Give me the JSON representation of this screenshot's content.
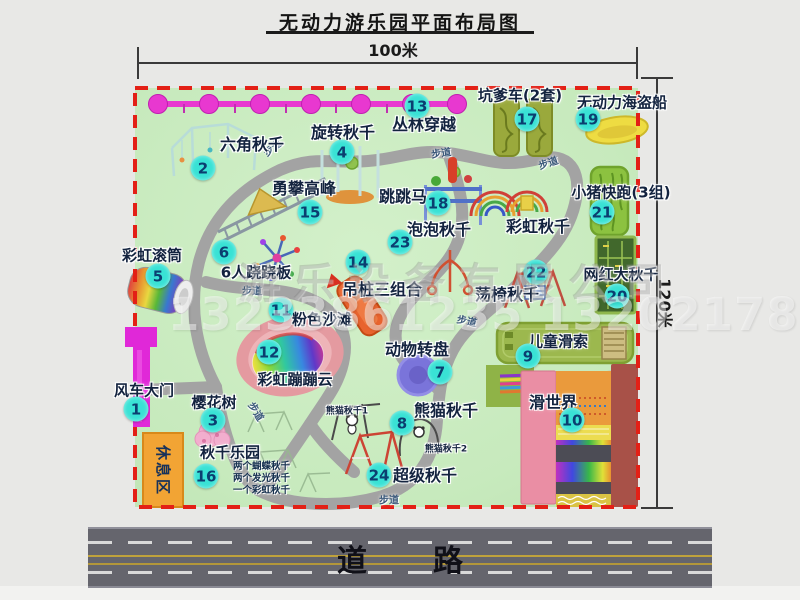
{
  "title": "无动力游乐园平面布局图",
  "dimensions": {
    "width_label": "100米",
    "height_label": "120米"
  },
  "road": {
    "label": "道路"
  },
  "rest_area": {
    "label": "休息区"
  },
  "watermark": {
    "company": "游乐设备有限公司",
    "phones": "13233861235 13202178333"
  },
  "attractions": [
    {
      "num": "1",
      "name": "风车大门",
      "bx": 136,
      "by": 409,
      "lx": 144,
      "ly": 390,
      "fs": 15
    },
    {
      "num": "2",
      "name": "六角秋千",
      "bx": 203,
      "by": 168,
      "lx": 252,
      "ly": 143,
      "fs": 16
    },
    {
      "num": "3",
      "name": "樱花树",
      "bx": 213,
      "by": 420,
      "lx": 214,
      "ly": 402,
      "fs": 15
    },
    {
      "num": "4",
      "name": "旋转秋千",
      "bx": 342,
      "by": 152,
      "lx": 343,
      "ly": 131,
      "fs": 16
    },
    {
      "num": "5",
      "name": "彩虹滚筒",
      "bx": 158,
      "by": 276,
      "lx": 152,
      "ly": 255,
      "fs": 15
    },
    {
      "num": "6",
      "name": "6人跷跷板",
      "bx": 224,
      "by": 252,
      "lx": 256,
      "ly": 272,
      "fs": 15
    },
    {
      "num": "7",
      "name": "动物转盘",
      "bx": 440,
      "by": 372,
      "lx": 417,
      "ly": 348,
      "fs": 16
    },
    {
      "num": "8",
      "name": "熊猫秋千",
      "bx": 402,
      "by": 423,
      "lx": 446,
      "ly": 409,
      "fs": 16
    },
    {
      "num": "9",
      "name": "儿童滑索",
      "bx": 528,
      "by": 356,
      "lx": 558,
      "ly": 341,
      "fs": 15
    },
    {
      "num": "10",
      "name": "滑世界",
      "bx": 572,
      "by": 420,
      "lx": 553,
      "ly": 401,
      "fs": 16
    },
    {
      "num": "11",
      "name": "粉色沙滩",
      "bx": 281,
      "by": 310,
      "lx": 322,
      "ly": 319,
      "fs": 15
    },
    {
      "num": "12",
      "name": "彩虹蹦蹦云",
      "bx": 269,
      "by": 352,
      "lx": 295,
      "ly": 379,
      "fs": 15
    },
    {
      "num": "13",
      "name": "丛林穿越",
      "bx": 417,
      "by": 106,
      "lx": 424,
      "ly": 123,
      "fs": 16
    },
    {
      "num": "14",
      "name": "吊桩三组合",
      "bx": 358,
      "by": 262,
      "lx": 382,
      "ly": 288,
      "fs": 16
    },
    {
      "num": "15",
      "name": "勇攀高峰",
      "bx": 310,
      "by": 212,
      "lx": 304,
      "ly": 187,
      "fs": 16
    },
    {
      "num": "16",
      "name": "秋千乐园",
      "bx": 206,
      "by": 476,
      "lx": 230,
      "ly": 452,
      "fs": 15
    },
    {
      "num": "17",
      "name": "坑爹车(2套)",
      "bx": 527,
      "by": 119,
      "lx": 520,
      "ly": 95,
      "fs": 15
    },
    {
      "num": "18",
      "name": "跳跳马",
      "bx": 438,
      "by": 203,
      "lx": 403,
      "ly": 195,
      "fs": 16
    },
    {
      "num": "19",
      "name": "无动力海盗船",
      "bx": 588,
      "by": 119,
      "lx": 622,
      "ly": 102,
      "fs": 15
    },
    {
      "num": "20",
      "name": "网红大秋千",
      "bx": 617,
      "by": 296,
      "lx": 621,
      "ly": 274,
      "fs": 15
    },
    {
      "num": "21",
      "name": "小猪快跑(3组)",
      "bx": 602,
      "by": 212,
      "lx": 621,
      "ly": 192,
      "fs": 15
    },
    {
      "num": "22",
      "name": "荡椅秋千",
      "bx": 536,
      "by": 272,
      "lx": 507,
      "ly": 293,
      "fs": 16
    },
    {
      "num": "23",
      "name": "泡泡秋千",
      "bx": 400,
      "by": 242,
      "lx": 439,
      "ly": 228,
      "fs": 16
    },
    {
      "num": "24",
      "name": "超级秋千",
      "bx": 379,
      "by": 475,
      "lx": 425,
      "ly": 474,
      "fs": 16
    }
  ],
  "extra_labels": [
    {
      "text": "彩虹秋千",
      "x": 538,
      "y": 225,
      "fs": 16
    },
    {
      "text": "熊猫秋千1",
      "x": 347,
      "y": 410,
      "fs": 9
    },
    {
      "text": "熊猫秋千2",
      "x": 446,
      "y": 448,
      "fs": 9
    }
  ],
  "path_labels": [
    {
      "text": "步道",
      "x": 272,
      "y": 147,
      "rot": -38
    },
    {
      "text": "步道",
      "x": 441,
      "y": 152,
      "rot": -8
    },
    {
      "text": "步道",
      "x": 548,
      "y": 162,
      "rot": -18
    },
    {
      "text": "步道",
      "x": 252,
      "y": 290,
      "rot": 0
    },
    {
      "text": "步道",
      "x": 467,
      "y": 320,
      "rot": 12
    },
    {
      "text": "步道",
      "x": 257,
      "y": 411,
      "rot": 58
    },
    {
      "text": "步道",
      "x": 389,
      "y": 499,
      "rot": 0
    }
  ],
  "swing_park_notes": [
    "两个蝴蝶秋千",
    "两个发光秋千",
    "一个彩虹秋千"
  ],
  "colors": {
    "map_green": "#c7eabd",
    "border_red": "#e32016",
    "badge_cyan": "#39e2d5",
    "chain_magenta": "#e838d0",
    "gate_magenta": "#e028d8",
    "rest_orange": "#f2a434",
    "road_gray": "#65656d"
  }
}
